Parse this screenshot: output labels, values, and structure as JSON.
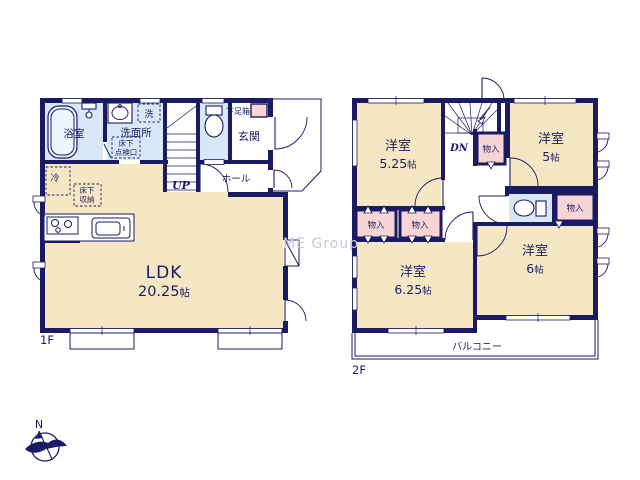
{
  "watermark": "ME Group",
  "compass": {
    "north": "N"
  },
  "palette": {
    "navy": "#1b1b64",
    "beige": "#f6e7c4",
    "lightblue": "#d9e8f6",
    "pink": "#f7d5d5",
    "watermark": "#c6cad2",
    "paper": "#ffffff"
  },
  "floor1": {
    "label": "1F",
    "bath": "浴室",
    "washroom": "洗面所",
    "laundry": "洗",
    "underfloor_access": [
      "床下",
      "点検口"
    ],
    "shoe_box": "下足箱",
    "entrance": "玄関",
    "hall": "ホール",
    "stairs": "UP",
    "fridge": "冷",
    "underfloor_storage": [
      "床下",
      "収納"
    ],
    "ldk": {
      "name": "LDK",
      "size_num": "20.25",
      "size_unit": "帖"
    }
  },
  "floor2": {
    "label": "2F",
    "stairs": "DN",
    "closet": "物入",
    "balcony": "バルコニー",
    "rooms": {
      "nw": {
        "name": "洋室",
        "size_num": "5.25",
        "size_unit": "帖"
      },
      "ne": {
        "name": "洋室",
        "size_num": "5",
        "size_unit": "帖"
      },
      "sw": {
        "name": "洋室",
        "size_num": "6.25",
        "size_unit": "帖"
      },
      "se": {
        "name": "洋室",
        "size_num": "6",
        "size_unit": "帖"
      }
    }
  }
}
